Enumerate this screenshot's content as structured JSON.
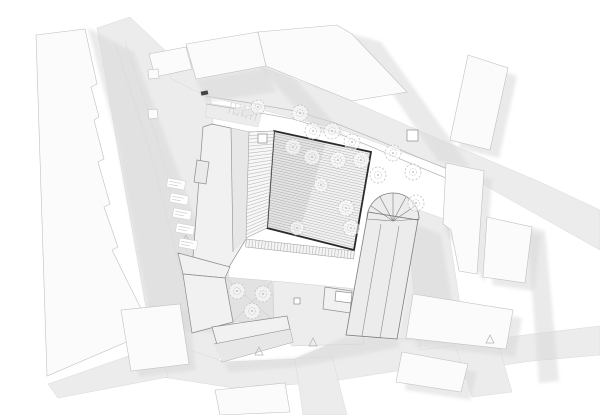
{
  "meta": {
    "width": 600,
    "height": 415,
    "drawing_kind": "architectural-site-plan"
  },
  "colors": {
    "background": "#ffffff",
    "street": "#ececec",
    "street_stroke": "#d9d9d9",
    "top_band": "#ebebeb",
    "paving": "#ededed",
    "courtyard": "#e2e2e2",
    "shadow": "#d9d9d9",
    "context_fill": "#fbfbfb",
    "context_stroke": "#c0c0c0",
    "project_fill": "#f1f1f1",
    "project_fill_dark": "#e7e7e7",
    "project_stroke": "#8c8c8c",
    "hall_outline": "#2b2b2b",
    "hall_fill": "#f2f2f2",
    "hatch": "#a8a8a8",
    "tree": "#c2c2c2",
    "detail": "#9a9a9a",
    "lane": "#dedede"
  },
  "streets": [
    {
      "name": "street-left",
      "points": "97,28 130,17 210,93 228,268 236,342 206,372 150,331 116,138"
    },
    {
      "name": "street-bottom",
      "points": "160,340 225,362 295,359 345,338 397,338 462,344 532,334 600,326 600,355 532,361 462,371 397,371 332,381 240,389 162,377"
    },
    {
      "name": "street-bottom-tail",
      "points": "48,384 160,345 168,377 58,398"
    },
    {
      "name": "street-stub-south",
      "points": "295,359 332,356 347,415 303,415"
    },
    {
      "name": "street-stub-east",
      "points": "455,345 497,340 512,392 472,397"
    },
    {
      "name": "street-right",
      "points": "405,205 447,220 466,344 420,350"
    },
    {
      "name": "street-top-band",
      "points": "170,58 258,66 340,96 420,131 540,182 600,210 600,250 468,176 342,130 206,96 170,78"
    },
    {
      "name": "parking-area",
      "points": "207,103 262,112 258,127 205,117"
    }
  ],
  "paving": [
    {
      "name": "paving-southeast-court",
      "points": "273,281 357,289 364,344 292,346 274,322",
      "fill": "paving"
    },
    {
      "name": "courtyard-southwest",
      "points": "225,277 272,281 274,321 233,322",
      "fill": "courtyard",
      "cross": true
    }
  ],
  "shadows": [
    {
      "name": "shadow-left-block",
      "points": "88,28 134,52 238,333 152,331 116,137"
    },
    {
      "name": "shadow-top-1",
      "points": "255,62 286,69 346,136 316,131"
    },
    {
      "name": "shadow-top-2",
      "points": "352,34 381,42 470,167 438,161"
    },
    {
      "name": "shadow-top-3",
      "points": "196,80 266,68 276,92 206,102"
    },
    {
      "name": "shadow-ne-building",
      "points": "477,63 517,76 499,158 459,148"
    },
    {
      "name": "shadow-e-building-1",
      "points": "455,171 492,179 485,282 445,232"
    },
    {
      "name": "shadow-e-building-2",
      "points": "496,225 541,235 534,291 492,285"
    },
    {
      "name": "shadow-se-building-1",
      "points": "422,302 522,318 515,357 415,346"
    },
    {
      "name": "shadow-se-building-2",
      "points": "411,360 477,372 470,400 405,390"
    },
    {
      "name": "shadow-church-east",
      "points": "397,340 417,225 441,234 459,343"
    },
    {
      "name": "shadow-complex-south",
      "points": "224,362 295,358 345,337 397,337 400,347 298,367 228,372"
    },
    {
      "name": "shadow-right-band",
      "points": "527,226 545,231 559,381 539,383"
    },
    {
      "name": "shadow-sw-building",
      "points": "130,316 188,310 196,370 139,377"
    }
  ],
  "context_buildings": [
    {
      "name": "context-block-west",
      "points": "36,35 85,29 97,84 91,87 99,117 94,120 104,159 98,162 110,204 104,207 118,247 112,250 152,331 47,376"
    },
    {
      "name": "context-building-sw",
      "points": "121,310 180,304 189,364 131,371"
    },
    {
      "name": "context-building-nw",
      "points": "149,54 186,47 192,69 155,77"
    },
    {
      "name": "context-annex-nw-1",
      "points": "148,70 158,69 159,78 149,79"
    },
    {
      "name": "context-annex-nw-2",
      "points": "148,110 157,109 158,118 149,119"
    },
    {
      "name": "context-building-n1",
      "points": "186,44 258,32 266,66 196,79"
    },
    {
      "name": "context-building-n2",
      "points": "258,32 337,25 352,34 407,92 352,101 266,66"
    },
    {
      "name": "context-building-ne",
      "points": "468,55 508,68 490,150 450,140"
    },
    {
      "name": "context-building-e1",
      "points": "446,163 484,171 477,274 459,271 451,230 443,224"
    },
    {
      "name": "context-building-e2",
      "points": "487,217 532,227 525,283 483,277"
    },
    {
      "name": "context-building-se1",
      "points": "413,294 513,310 506,349 406,338"
    },
    {
      "name": "context-building-se2",
      "points": "402,352 468,364 461,392 396,382"
    },
    {
      "name": "context-building-s",
      "points": "215,390 285,383 290,412 220,415"
    }
  ],
  "project_buildings": [
    {
      "name": "project-wing-northwest",
      "points": "212,124 249,132 246,239 229,267 193,257 203,127",
      "face": "231,128 249,132 246,239 233,252",
      "lines": [
        [
          231,
          128,
          233,
          252
        ]
      ]
    },
    {
      "name": "project-corner-hip",
      "points": "178,253 230,267 225,278 183,274"
    },
    {
      "name": "project-wing-west",
      "points": "183,274 225,278 233,322 192,333"
    },
    {
      "name": "project-wing-south",
      "points": "212,327 287,316 293,342 222,362",
      "face": "214,344 290,329 293,342 222,362",
      "lines": [
        [
          214,
          344,
          290,
          329
        ]
      ]
    },
    {
      "name": "project-shed",
      "points": "325,287 352,291 350,313 323,309"
    },
    {
      "name": "project-shed-white",
      "points": "336,291 352,293 351,303 335,301",
      "fillhex": "#ffffff"
    },
    {
      "name": "project-hatched-patch",
      "points": "197,160 209,162 206,184 194,182",
      "fillhex": "#eaeaea"
    }
  ],
  "church": {
    "name": "church-building",
    "nave": "368,212 418,220 397,339 346,335",
    "ridges": [
      [
        381,
        224,
        362,
        336
      ],
      [
        399,
        226,
        380,
        338
      ]
    ],
    "apse": {
      "cx": 393,
      "cy": 219,
      "r": 26,
      "rays": [
        [
          367,
          219
        ],
        [
          371,
          206
        ],
        [
          380,
          197
        ],
        [
          393,
          193
        ],
        [
          406,
          197
        ],
        [
          415,
          206
        ],
        [
          419,
          219
        ]
      ]
    }
  },
  "hall": {
    "name": "main-hall-roof",
    "outline": "274,131 371,152 354,250 267,228",
    "hatch_n": 38,
    "wash": "274,131 326,142 298,236 267,228",
    "ladder": {
      "left": [
        249,
        132,
        246,
        238
      ],
      "right": [
        274,
        131,
        267,
        228
      ],
      "n": 30
    },
    "band": {
      "a": [
        246,
        243
      ],
      "b": [
        354,
        255
      ],
      "half": 4,
      "n": 34
    }
  },
  "paths": [
    {
      "name": "path-curve-upper",
      "points": "205,96 250,103 295,111 335,123 375,139 415,156 450,170 470,178"
    },
    {
      "name": "path-curve-lower",
      "points": "206,104 250,111 293,119 332,131 372,147 412,164 446,178 466,186"
    },
    {
      "name": "lane-line-1",
      "points": "115,44 150,150 178,260 196,330"
    },
    {
      "name": "lane-line-2",
      "points": "125,41 160,148 188,258 206,330"
    }
  ],
  "parking_ticks": {
    "a": [
      232,
      102
    ],
    "b": [
      258,
      110
    ],
    "n": 7,
    "len": 12
  },
  "cars": [
    {
      "x": 237,
      "y": 104,
      "w": 6,
      "h": 13,
      "rot": 78
    },
    {
      "x": 246,
      "y": 106,
      "w": 6,
      "h": 13,
      "rot": 81
    }
  ],
  "trees": [
    [
      258,
      107,
      7
    ],
    [
      300,
      113,
      8
    ],
    [
      313,
      131,
      8
    ],
    [
      332,
      131,
      8
    ],
    [
      352,
      142,
      8
    ],
    [
      293,
      147,
      8
    ],
    [
      312,
      157,
      8
    ],
    [
      338,
      160,
      8
    ],
    [
      361,
      160,
      8
    ],
    [
      378,
      175,
      8
    ],
    [
      393,
      153,
      8
    ],
    [
      413,
      172,
      8
    ],
    [
      416,
      203,
      8
    ],
    [
      346,
      208,
      8
    ],
    [
      351,
      228,
      8
    ],
    [
      297,
      228,
      7
    ],
    [
      321,
      185,
      7
    ],
    [
      237,
      291,
      8
    ],
    [
      263,
      294,
      8
    ],
    [
      252,
      311,
      8
    ]
  ],
  "squares": [
    {
      "x": 258,
      "y": 134,
      "s": 9
    },
    {
      "x": 407,
      "y": 130,
      "s": 11
    },
    {
      "x": 294,
      "y": 298,
      "s": 6
    }
  ],
  "triangles": [
    "259,347 263,355 255,355",
    "313,338 317,346 309,346",
    "490,335 494,343 486,343",
    "186,235 190,243 182,243"
  ],
  "gate_marker": {
    "x": 201,
    "y": 91,
    "w": 7,
    "h": 4,
    "rot": -12
  },
  "label_boxes": [
    {
      "x": 168,
      "y": 178
    },
    {
      "x": 171,
      "y": 193
    },
    {
      "x": 174,
      "y": 208
    },
    {
      "x": 177,
      "y": 223
    },
    {
      "x": 180,
      "y": 238
    }
  ]
}
